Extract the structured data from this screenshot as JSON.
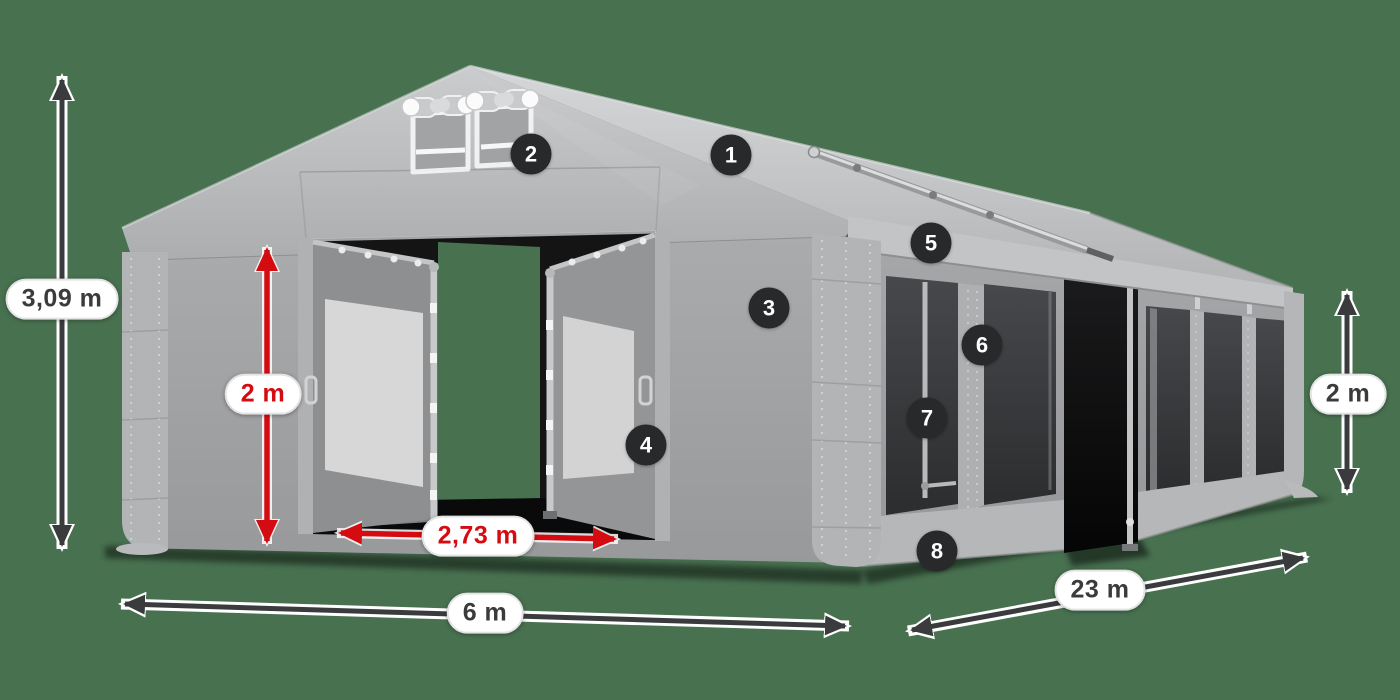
{
  "scene": {
    "description": "Gray modular party tent 3D product render with dimension annotations",
    "background_color": "#487150"
  },
  "dimensions": {
    "total_height": {
      "value": "3,09 m",
      "style": "dark"
    },
    "entrance_height": {
      "value": "2 m",
      "style": "red"
    },
    "entrance_width": {
      "value": "2,73 m",
      "style": "red"
    },
    "tent_width": {
      "value": "6 m",
      "style": "dark"
    },
    "tent_length": {
      "value": "23 m",
      "style": "dark"
    },
    "side_wall_height": {
      "value": "2 m",
      "style": "dark"
    }
  },
  "callouts": [
    {
      "number": "1"
    },
    {
      "number": "2"
    },
    {
      "number": "3"
    },
    {
      "number": "4"
    },
    {
      "number": "5"
    },
    {
      "number": "6"
    },
    {
      "number": "7"
    },
    {
      "number": "8"
    }
  ],
  "colors": {
    "background": "#487150",
    "dimension_dark": "#3a3b3d",
    "dimension_red": "#d40b10",
    "badge_background": "#28292b",
    "badge_text": "#ffffff",
    "label_background": "#ffffff",
    "tent_light_gray": "#c6c7c9",
    "tent_mid_gray": "#a2a3a5",
    "tent_dark_window": "#353638"
  }
}
